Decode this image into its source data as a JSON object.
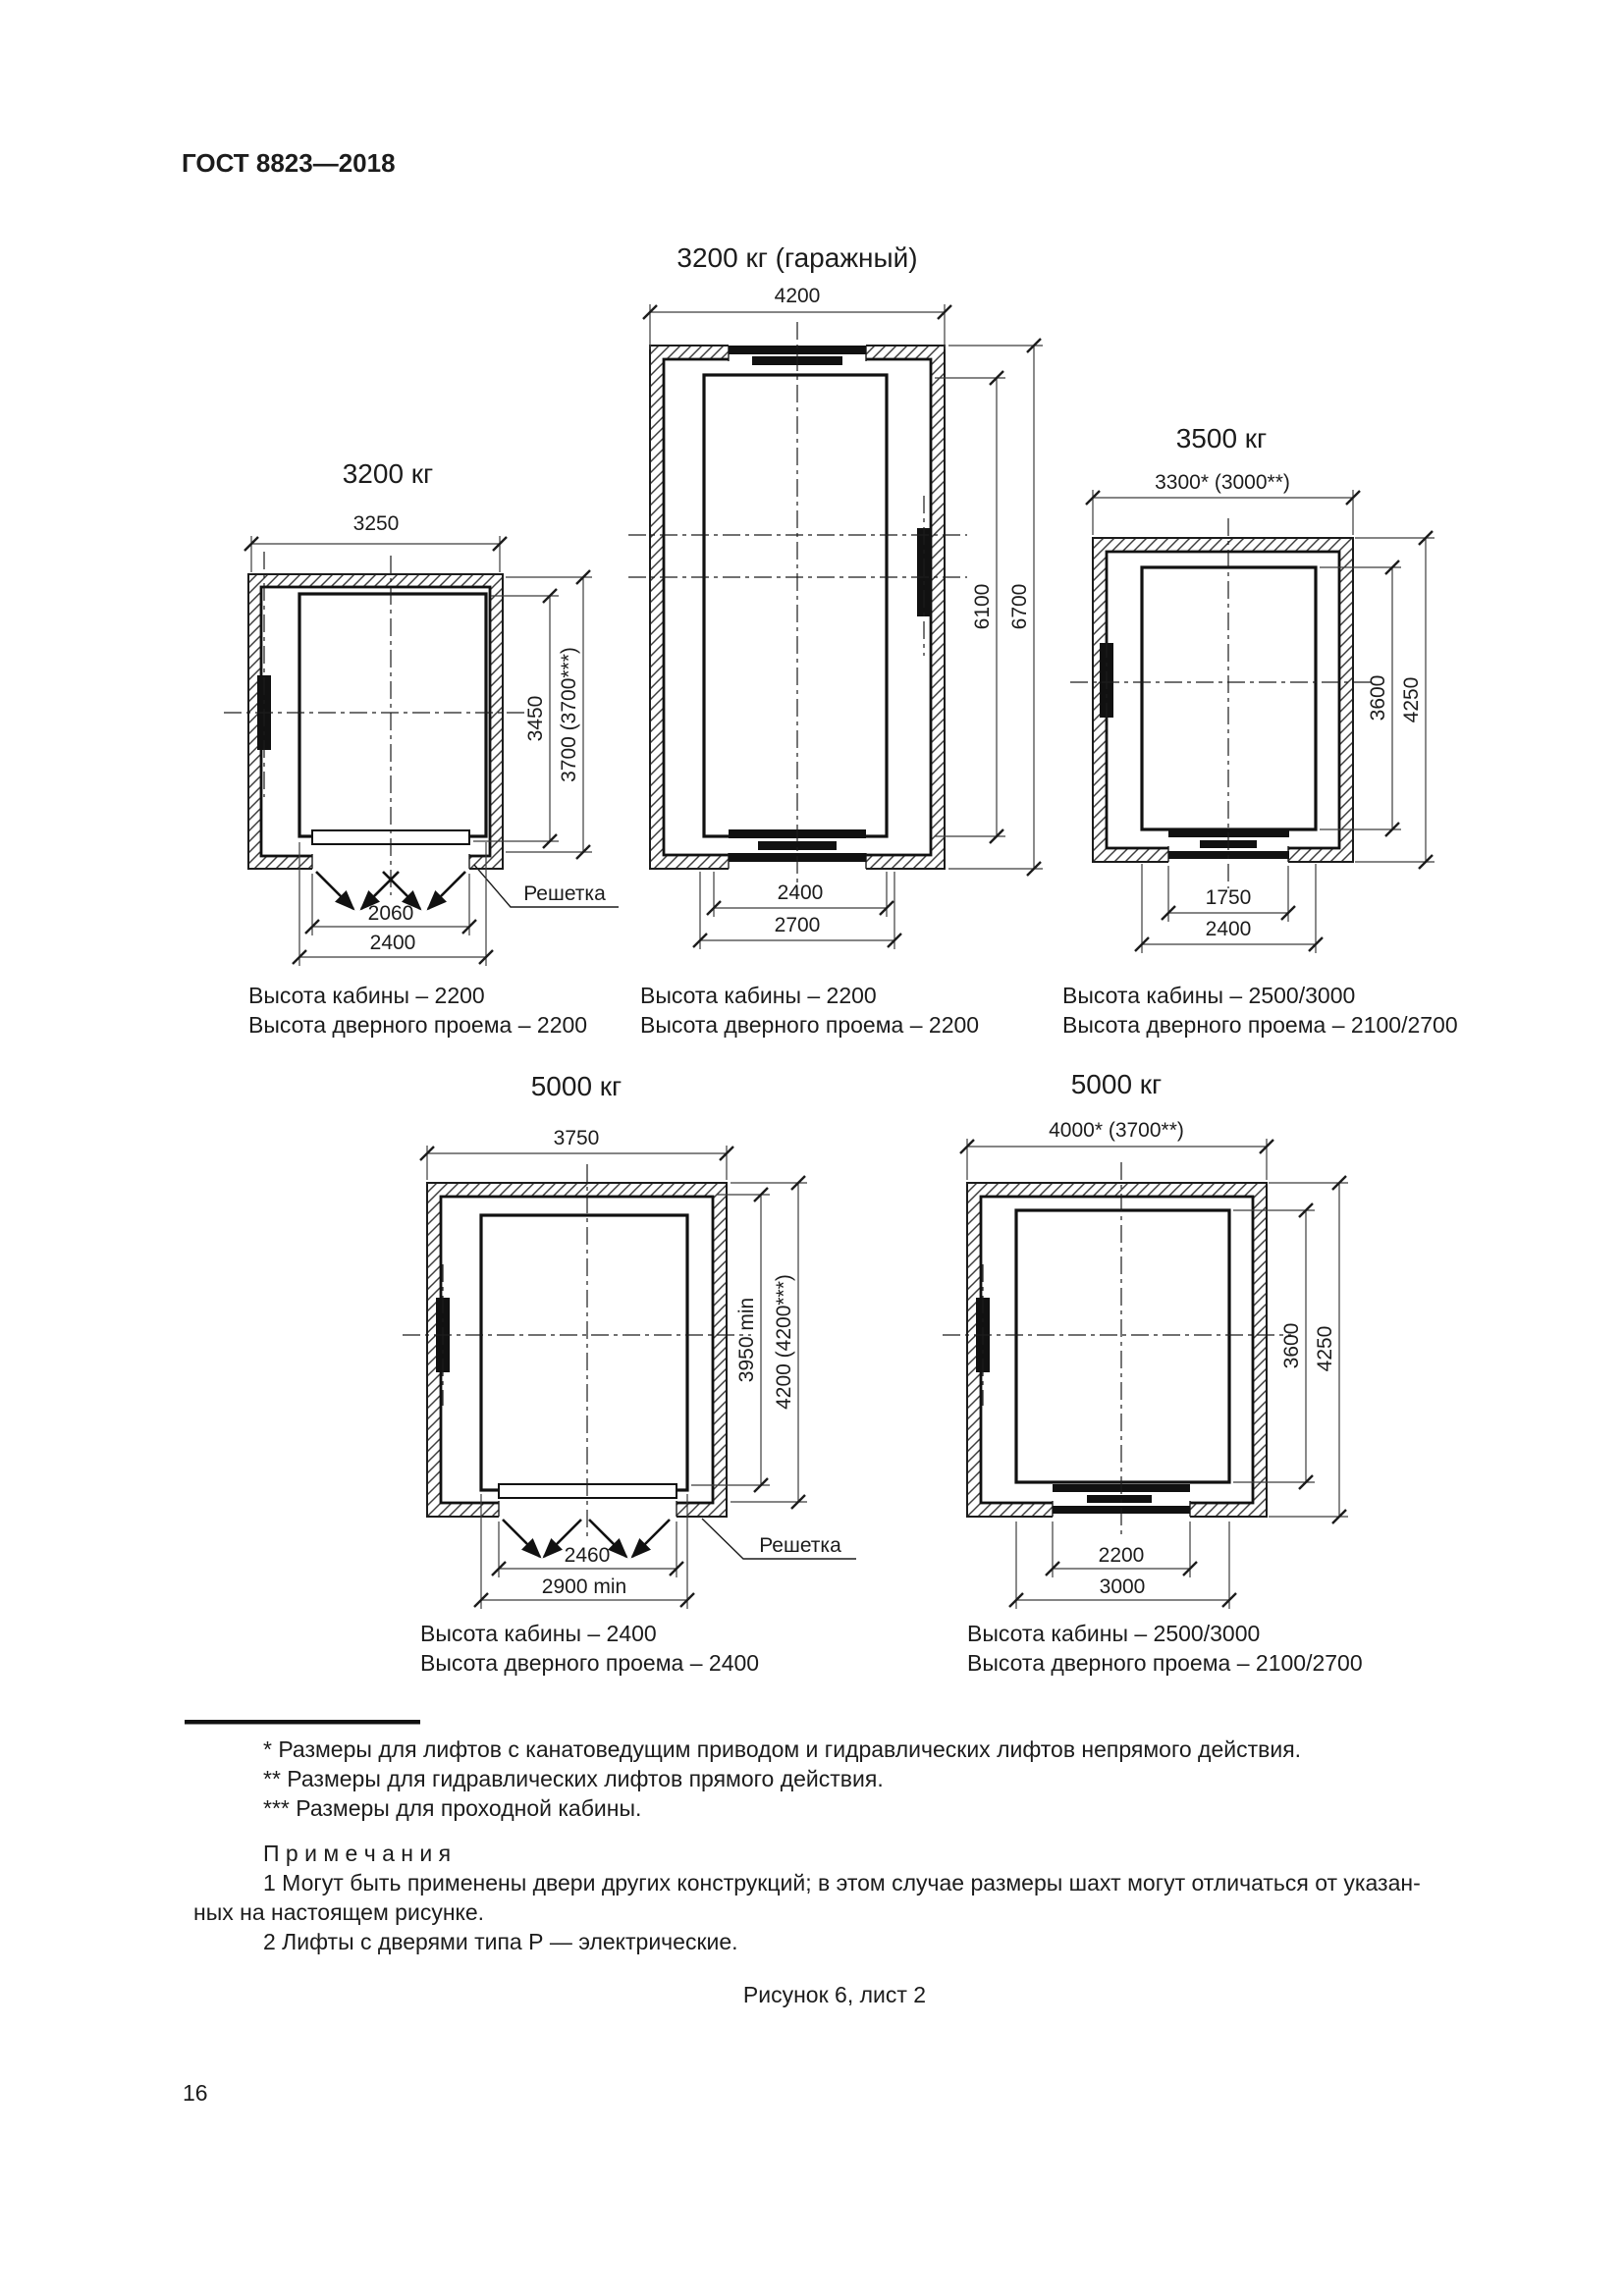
{
  "page": {
    "header": "ГОСТ 8823—2018",
    "figure_caption": "Рисунок 6, лист 2",
    "page_number": "16"
  },
  "diagrams": {
    "garage": {
      "title": "3200 кг (гаражный)",
      "width_dim": "4200",
      "height_dim_inner": "6100",
      "height_dim_outer": "6700",
      "bottom_dim_inner": "2400",
      "bottom_dim_outer": "2700",
      "caption_line1": "Высота кабины – 2200",
      "caption_line2": "Высота дверного проема – 2200"
    },
    "left3200": {
      "title": "3200 кг",
      "width_dim": "3250",
      "height_dim_inner": "3450",
      "height_dim_outer": "3700 (3700***)",
      "bottom_dim_inner": "2060",
      "bottom_dim_outer": "2400",
      "grille_label": "Решетка",
      "caption_line1": "Высота кабины – 2200",
      "caption_line2": "Высота дверного проема – 2200"
    },
    "right3500": {
      "title": "3500 кг",
      "width_dim": "3300* (3000**)",
      "height_dim_inner": "3600",
      "height_dim_outer": "4250",
      "bottom_dim_inner": "1750",
      "bottom_dim_outer": "2400",
      "caption_line1": "Высота кабины – 2500/3000",
      "caption_line2": "Высота дверного проема – 2100/2700"
    },
    "bottomleft5000": {
      "title": "5000 кг",
      "width_dim": "3750",
      "height_dim_inner": "3950 min",
      "height_dim_outer": "4200 (4200***)",
      "bottom_dim_inner": "2460",
      "bottom_dim_outer": "2900 min",
      "grille_label": "Решетка",
      "caption_line1": "Высота кабины – 2400",
      "caption_line2": "Высота дверного проема – 2400"
    },
    "bottomright5000": {
      "title": "5000 кг",
      "width_dim": "4000* (3700**)",
      "height_dim_inner": "3600",
      "height_dim_outer": "4250",
      "bottom_dim_inner": "2200",
      "bottom_dim_outer": "3000",
      "caption_line1": "Высота кабины – 2500/3000",
      "caption_line2": "Высота дверного проема – 2100/2700"
    }
  },
  "footnotes": [
    "*  Размеры для лифтов с канатоведущим приводом и гидравлических лифтов непрямого действия.",
    "**  Размеры для гидравлических лифтов прямого действия.",
    "***  Размеры для проходной кабины."
  ],
  "notes": {
    "heading": "П р и м е ч а н и я",
    "note1_line1": "1 Могут быть применены двери других конструкций; в этом случае размеры шахт могут отличаться от указан-",
    "note1_line2": "ных на настоящем рисунке.",
    "note2": "2 Лифты с дверями типа Р — электрические."
  }
}
